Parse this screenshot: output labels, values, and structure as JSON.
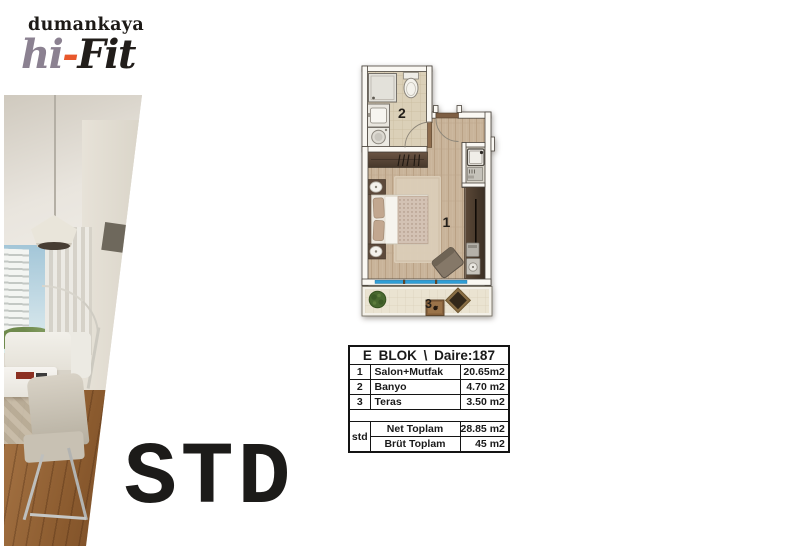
{
  "brand": {
    "name": "dumankaya",
    "hi": "hi",
    "dash": "-",
    "fit": "Fit"
  },
  "type_label": "STD",
  "floor_plan": {
    "labels": {
      "salon": "1",
      "banyo": "2",
      "teras": "3"
    }
  },
  "area_table": {
    "title": "E BLOK \\ Daire:187",
    "rows": [
      {
        "no": "1",
        "room": "Salon+Mutfak",
        "area": "20.65m2"
      },
      {
        "no": "2",
        "room": "Banyo",
        "area": "4.70 m2"
      },
      {
        "no": "3",
        "room": "Teras",
        "area": "3.50 m2"
      }
    ],
    "summary": {
      "label": "std",
      "net_label": "Net Toplam",
      "net_value": "28.85 m2",
      "brut_label": "Brüt Toplam",
      "brut_value": "45 m2"
    }
  },
  "colors": {
    "brand_gray": "#8b8191",
    "accent_orange": "#e8582c",
    "window_blue": "#2f9ed6",
    "wood_floor": "#c9b49a",
    "dark_wood": "#5d4a3b",
    "bath_tile": "#dbd0b8",
    "terrace_tile": "#eae3d1"
  }
}
